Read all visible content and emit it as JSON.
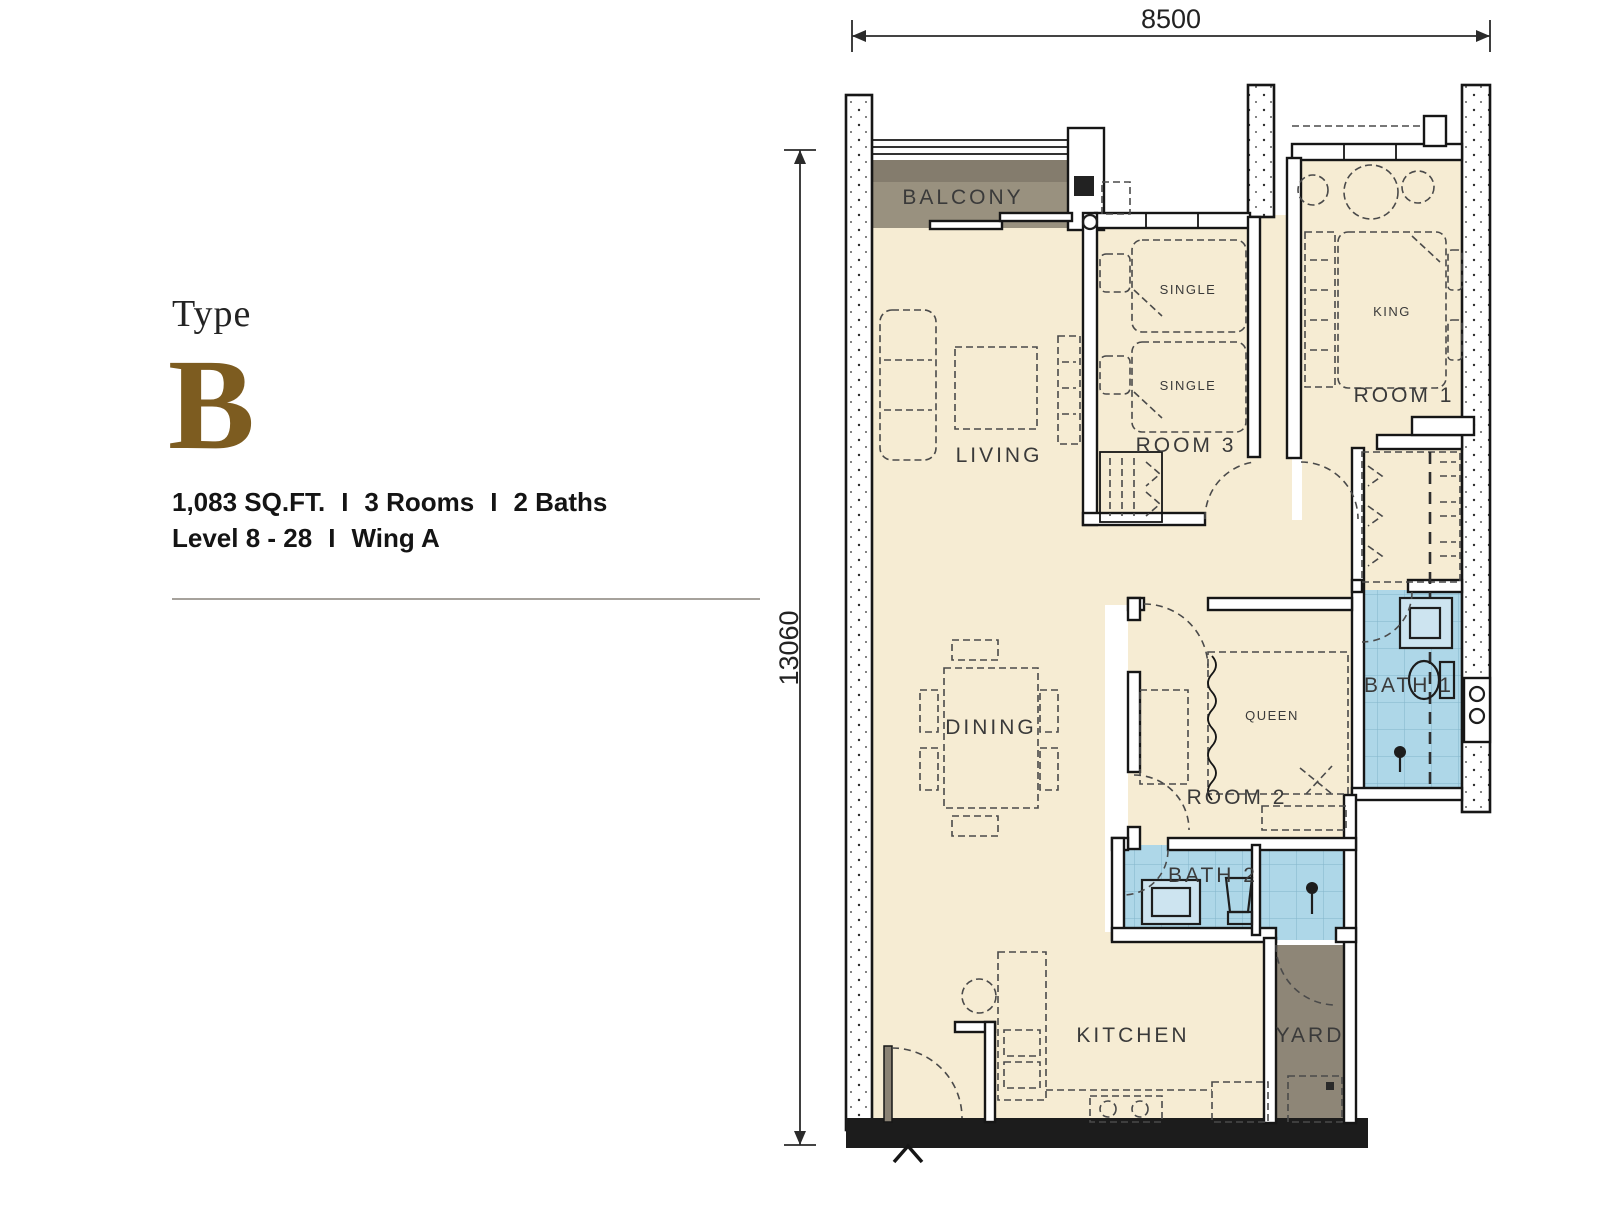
{
  "info_panel": {
    "type_label": "Type",
    "type_letter": "B",
    "area": "1,083 SQ.FT.",
    "rooms": "3 Rooms",
    "baths": "2 Baths",
    "level": "Level 8 - 28",
    "wing": "Wing A",
    "separator": "I"
  },
  "dimensions": {
    "top": "8500",
    "left": "13060"
  },
  "rooms": {
    "balcony": "BALCONY",
    "living": "LIVING",
    "dining": "DINING",
    "kitchen": "KITCHEN",
    "yard": "YARD",
    "room1": "ROOM 1",
    "room2": "ROOM 2",
    "room3": "ROOM 3",
    "bath1": "BATH 1",
    "bath2": "BATH 2"
  },
  "furniture": {
    "king": "KING",
    "queen": "QUEEN",
    "single": "SINGLE"
  },
  "colors": {
    "floor": "#f6ecd3",
    "bath_tile": "#aed7e8",
    "balcony_gray": "#99917f",
    "balcony_band": "#847c6d",
    "yard_gray": "#8e8677",
    "accent_gold": "#7d5c20",
    "wall_ink": "#161616"
  }
}
